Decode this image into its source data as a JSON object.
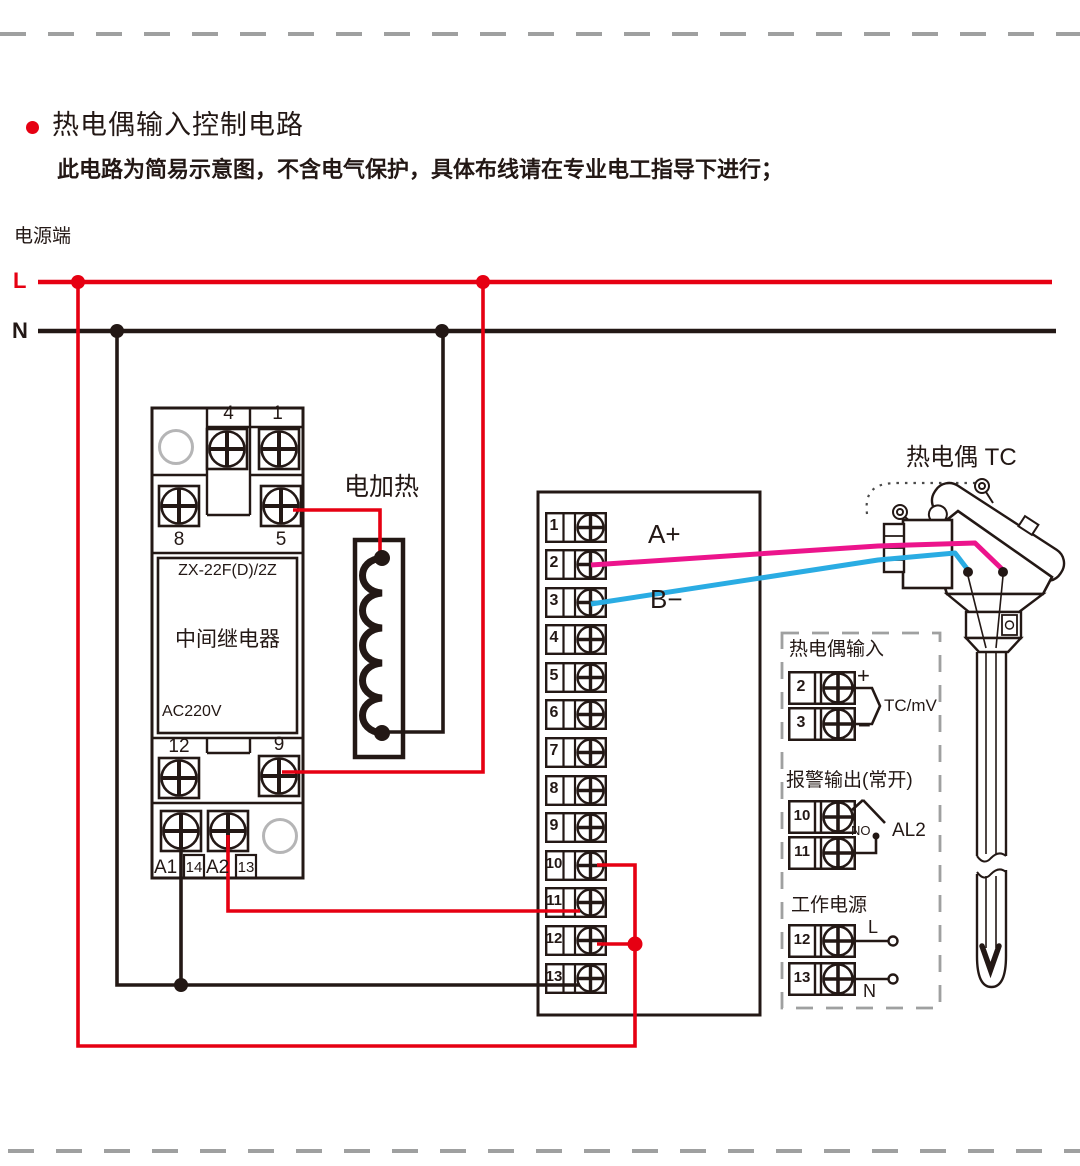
{
  "page": {
    "title": "热电偶输入控制电路",
    "subtitle": "此电路为简易示意图，不含电气保护，具体布线请在专业电工指导下进行；",
    "power_label": "电源端",
    "line_l": "L",
    "line_n": "N"
  },
  "relay": {
    "model": "ZX-22F(D)/2Z",
    "name": "中间继电器",
    "voltage": "AC220V",
    "t4": "4",
    "t1": "1",
    "t8": "8",
    "t5": "5",
    "t12": "12",
    "t9": "9",
    "a1": "A1",
    "t14": "14",
    "a2": "A2",
    "t13": "13"
  },
  "heater": {
    "label": "电加热"
  },
  "block": {
    "terminals": [
      "1",
      "2",
      "3",
      "4",
      "5",
      "6",
      "7",
      "8",
      "9",
      "10",
      "11",
      "12",
      "13"
    ]
  },
  "signals": {
    "a_plus": "A+",
    "b_minus": "B−"
  },
  "thermocouple": {
    "label": "热电偶 TC"
  },
  "io": {
    "input": {
      "title": "热电偶输入",
      "t2": "2",
      "t3": "3",
      "plus": "+",
      "minus": "−",
      "signal": "TC/mV"
    },
    "alarm": {
      "title": "报警输出(常开)",
      "t10": "10",
      "t11": "11",
      "no": "NO",
      "name": "AL2"
    },
    "power": {
      "title": "工作电源",
      "t12": "12",
      "t13": "13",
      "l": "L",
      "n": "N"
    }
  },
  "colors": {
    "live_red": "#e60012",
    "signal_magenta": "#ec148c",
    "signal_blue": "#2aace3",
    "wire_black": "#231815",
    "dash_gray": "#9fa0a0",
    "circle_gray": "#b5b5b6"
  }
}
